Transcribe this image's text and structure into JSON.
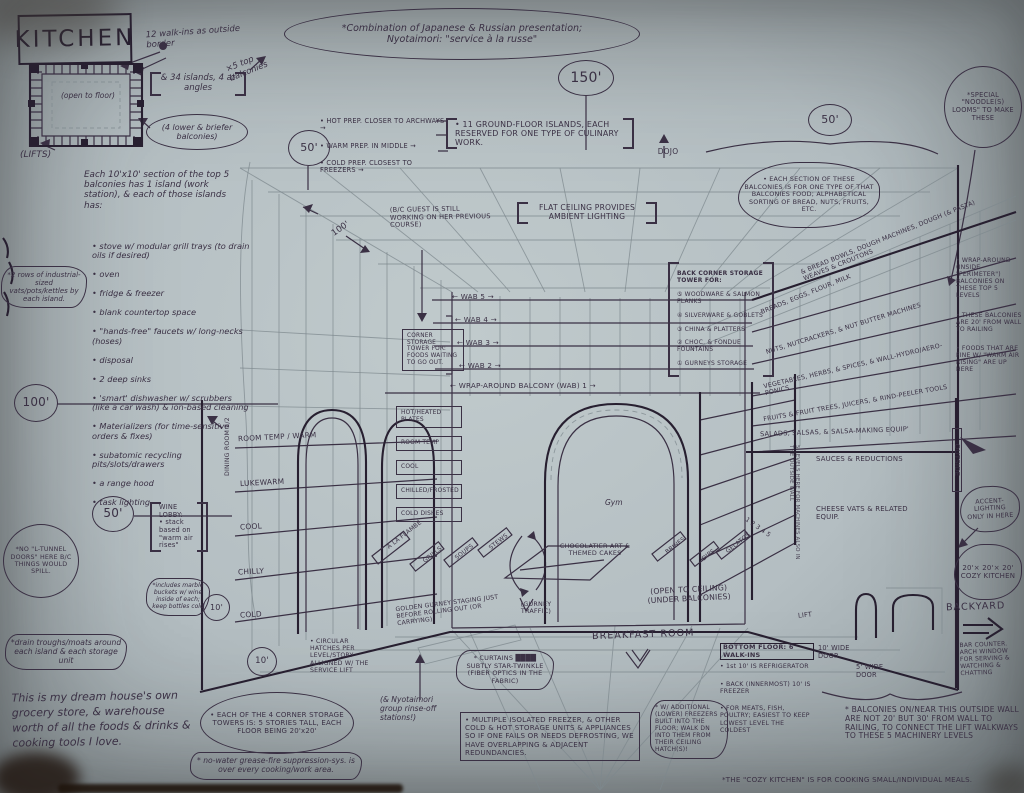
{
  "paper": {
    "bg": "#b6c0c3",
    "ink": "#3a3044",
    "heavy_ink": "#271f30",
    "pencil": "#7d888e"
  },
  "title": "KITCHEN",
  "header": {
    "combo": "*Combination of Japanese & Russian presentation;\nNyotaimori: \"service à la russe\"",
    "noodle_looms": "*SPECIAL \"NOODLE(S) LOOMS\" TO MAKE THESE",
    "dojo": "DOJO"
  },
  "dimensions": {
    "hall_150": "150'",
    "grid_50": "50'",
    "right_50": "50'",
    "left_100": "100'",
    "grid_100": "100'",
    "left_50": "50'",
    "lobby_10": "10'",
    "floor_10": "10'"
  },
  "plan_area": {
    "walk_ins": "12 walk-ins as outside border",
    "islands": "& 34 islands, 4 at angles",
    "top_balconies": "×5 top balconies",
    "lower_balconies": "(4 lower & briefer balconies)",
    "lifts": "(LIFTS)",
    "open_to_floor": "(open to floor)"
  },
  "left_column": {
    "vats": "*2 rows of industrial-sized vats/pots/kettles by each island.",
    "intro": "Each 10'x10' section of the top 5 balconies has 1 island (work station), & each of those islands has:",
    "bullets": [
      "• stove w/ modular grill trays (to drain oils if desired)",
      "• oven",
      "• fridge & freezer",
      "• blank countertop space",
      "• \"hands-free\" faucets w/ long-necks (hoses)",
      "• disposal",
      "• 2 deep sinks",
      "• 'smart' dishwasher w/ scrubbers (like a car wash) & ion-based cleaning",
      "• Materializers (for time-sensitive orders & fixes)",
      "• subatomic recycling pits/slots/drawers",
      "• a range hood",
      "• task lighting"
    ],
    "no_tunnel": "*NO \"L-TUNNEL DOORS\" HERE B/C THINGS WOULD SPILL.",
    "wine_lobby": "WINE LOBBY:\n• stack based on \"warm air rises\"",
    "wine_marble": "*includes marble buckets w/ wine inside of each; keep bottles cold",
    "drain": "*drain troughs/moats around each island & each storage unit",
    "dream": "This is my dream house's own grocery store, & warehouse worth of all the foods & drinks & cooking tools I love."
  },
  "prep": {
    "items": [
      "• HOT PREP. CLOSER TO ARCHWAYS →",
      "• WARM PREP. IN MIDDLE →",
      "• COLD PREP. CLOSEST TO FREEZERS →"
    ],
    "rule": "• 11 GROUND-FLOOR ISLANDS, EACH RESERVED FOR ONE TYPE OF CULINARY WORK."
  },
  "ceiling": {
    "flat": "FLAT CEILING PROVIDES AMBIENT LIGHTING",
    "guest": "(B/C GUEST IS STILL WORKING ON HER PREVIOUS COURSE)"
  },
  "wab": {
    "labels": [
      "← WAB 5 →",
      "← WAB 4 →",
      "← WAB 3 →",
      "← WAB 2 →"
    ],
    "wab1": "← WRAP-AROUND BALCONY (WAB) 1 →",
    "corner_tower": "CORNER STORAGE TOWER FOR: FOODS WAITING TO GO OUT.",
    "plate_stack": [
      "HOT/HEATED PLATES",
      "ROOM TEMP",
      "COOL",
      "CHILLED/FROSTED",
      "COLD DISHES"
    ],
    "temp_scale": [
      "ROOM TEMP / WARM",
      "LUKEWARM",
      "COOL",
      "CHILLY",
      "COLD"
    ],
    "dining_room": "DINING ROOM 2/2"
  },
  "back_wall": {
    "tower_header": "BACK CORNER STORAGE TOWER FOR:",
    "tower_items": [
      "⑤ WOODWARE & SALMON PLANKS",
      "④ SILVERWARE & GOBLETS",
      "③ CHINA & PLATTERS",
      "② CHOC. & FONDUE FOUNTAINS",
      "① GURNEYS STORAGE"
    ],
    "gym": "Gym"
  },
  "right_wall": {
    "section_note": "• EACH SECTION OF THESE BALCONIES IS FOR ONE TYPE OF THAT BALCONIES FOOD; ALPHABETICAL SORTING OF BREAD, NUTS, FRUITS, ETC.",
    "shelf_rows": [
      "& BREAD BOWLS, DOUGH MACHINES, DOUGH (& PASTA) WEAVES & CROUTONS",
      "BREADS, EGGS, FLOUR, MILK",
      "NUTS, NUTCRACKERS, & NUT BUTTER MACHINES",
      "VEGETABLES, HERBS, & SPICES, & WALL-HYDRO/AERO-PONICS",
      "FRUITS & FRUIT TREES, JUICERS, & RIND-PEELER TOOLS",
      "SALADS, SALSAS, & SALSA-MAKING EQUIP'"
    ],
    "sauces": "SAUCES & REDUCTIONS",
    "cheese": "CHEESE VATS & RELATED EQUIP.",
    "wraparound": [
      "• WRAP-AROUND (INSIDE \"PERIMETER\") BALCONIES ON THESE TOP 5 LEVELS",
      "• THESE BALCONIES ARE 20' FROM WALL TO RAILING",
      "• FOODS THAT ARE FINE W/ \"WARM AIR RISING\" ARE UP HERE"
    ],
    "machinery": "5 LEVELS HERE FOR MACHINES ALSO IN THE OUTSIDE WALL",
    "levels": "1  2  3  4  5",
    "outside": "OUTSIDE",
    "accent": "ACCENT-LIGHTING ONLY IN HERE"
  },
  "floor": {
    "islands": [
      "À LA FLAMBÉ",
      "GRILLS",
      "SOUPS",
      "STEWS",
      "BRINES",
      "DIPS",
      "GELATOS"
    ],
    "center_island": "CHOCOLATIER ART & THEMED CAKES",
    "gurney_traffic": "(GURNEY TRAFFIC)",
    "golden_gurney": "GOLDEN GURNEY STAGING JUST BEFORE ROLLING OUT (OR CARRYING)",
    "open_ceiling": "(OPEN TO CEILING)\n(UNDER BALCONIES)",
    "breakfast": "BREAKFAST ROOM",
    "lift": "LIFT",
    "hatches": "• CIRCULAR HATCHES PER LEVEL/STORY ALLIGNED W/ THE SERVICE LIFT",
    "rinse": "(& Nyotaimori group rinse-off stations!)"
  },
  "bottom_notes": {
    "corner_towers": "• EACH OF THE 4 CORNER STORAGE TOWERS IS: 5 STORIES TALL, EACH FLOOR BEING 20'x20'",
    "grease": "* no-water grease-fire suppression-sys. is over every cooking/work area.",
    "curtains": "* CURTAINS ████ SUBTLY STAR-TWINKLE (FIBER OPTICS IN THE FABRIC)",
    "redundancy": "• MULTIPLE ISOLATED FREEZER, & OTHER COLD & HOT STORAGE UNITS & APPLIANCES SO IF ONE FAILS OR NEEDS DEFROSTING, WE HAVE OVERLAPPING & ADJACENT REDUNDANCIES.",
    "lower_freezers": "* W/ ADDITIONAL (LOWER) FREEZERS BUILT INTO THE FLOOR; WALK DN INTO THEM FROM THEIR CEILING HATCH(S)!",
    "bottom_floor_header": "BOTTOM FLOOR: 6 WALK-INS",
    "bottom_floor_items": [
      "• 1st 10' IS REFRIGERATOR",
      "• BACK (INNERMOST) 10' IS FREEZER",
      "• FOR MEATS, FISH, POULTRY; EASIEST TO KEEP LOWEST LEVEL THE COLDEST"
    ],
    "door_10": "10' WIDE DOOR",
    "door_5": "5' WIDE DOOR",
    "backyard": "BACKYARD",
    "bar": "BAR COUNTER. ARCH WINDOW FOR SERVING & WATCHING & CHATTING",
    "balconies_wall": "* BALCONIES ON/NEAR THIS OUTSIDE WALL ARE NOT 20' BUT 30' FROM WALL TO RAILING, TO CONNECT THE LIFT WALKWAYS TO THESE 5 MACHINERY LEVELS",
    "cozy_dims": "20'× 20'× 20'\nCOZY KITCHEN",
    "cozy_note": "*THE \"COZY KITCHEN\" IS FOR COOKING SMALL/INDIVIDUAL MEALS."
  }
}
